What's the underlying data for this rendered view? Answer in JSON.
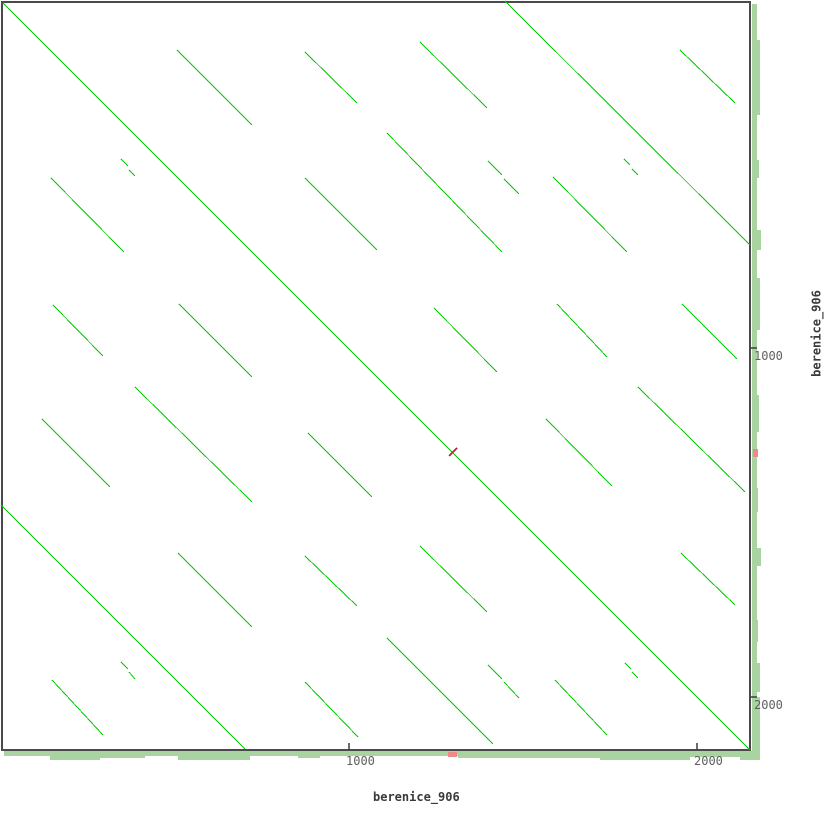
{
  "axis_labels": {
    "x": "berenice_906",
    "y": "berenice_906"
  },
  "axis": {
    "x_ticks": [
      {
        "label": "1000",
        "px": 349
      },
      {
        "label": "2000",
        "px": 697
      }
    ],
    "y_ticks": [
      {
        "label": "1000",
        "px": 348
      },
      {
        "label": "2000",
        "px": 697
      }
    ]
  },
  "colors": {
    "match_line": "#00cc00",
    "inverted_match": "#c22233",
    "density_band": "#a9d4a2",
    "band_red": "#ee8a8a",
    "plot_border": "#4a4a4a",
    "tick_mark": "#3c3c3c",
    "tick_text": "#5f5f5f",
    "label_text": "#3a3a3a",
    "background": "#ffffff"
  },
  "chart_data": {
    "type": "scatter",
    "subtype": "dotplot-self-alignment",
    "title": "",
    "xlabel": "berenice_906",
    "ylabel": "berenice_906",
    "x_range_bp": [
      0,
      2160
    ],
    "y_range_bp": [
      0,
      2160
    ],
    "tick_values_bp": [
      1000,
      2000
    ],
    "px_per_bp": 0.347,
    "plot_rect_px": {
      "x": 2,
      "y": 2,
      "w": 748,
      "h": 748
    },
    "main_diagonal_px": [
      3,
      3,
      750,
      750
    ],
    "match_segments_px": [
      [
        177,
        50,
        252,
        125
      ],
      [
        305,
        52,
        357,
        103
      ],
      [
        51,
        178,
        124,
        252
      ],
      [
        305,
        178,
        377,
        250
      ],
      [
        53,
        305,
        103,
        356
      ],
      [
        179,
        304,
        252,
        377
      ],
      [
        505,
        1,
        750,
        245
      ],
      [
        420,
        42,
        487,
        108
      ],
      [
        680,
        50,
        735,
        103
      ],
      [
        387,
        133,
        502,
        252
      ],
      [
        553,
        177,
        627,
        252
      ],
      [
        434,
        308,
        497,
        372
      ],
      [
        557,
        304,
        607,
        357
      ],
      [
        682,
        304,
        737,
        359
      ],
      [
        135,
        387,
        252,
        502
      ],
      [
        1,
        505,
        245,
        749
      ],
      [
        42,
        419,
        110,
        487
      ],
      [
        308,
        433,
        372,
        497
      ],
      [
        178,
        553,
        252,
        627
      ],
      [
        305,
        556,
        357,
        606
      ],
      [
        52,
        680,
        103,
        735
      ],
      [
        305,
        682,
        358,
        737
      ],
      [
        638,
        387,
        745,
        492
      ],
      [
        546,
        419,
        612,
        486
      ],
      [
        420,
        546,
        487,
        612
      ],
      [
        681,
        553,
        735,
        605
      ],
      [
        387,
        638,
        493,
        744
      ],
      [
        555,
        680,
        607,
        735
      ],
      [
        121,
        159,
        128,
        166
      ],
      [
        129,
        170,
        135,
        176
      ],
      [
        488,
        161,
        502,
        175
      ],
      [
        504,
        179,
        519,
        194
      ],
      [
        624,
        159,
        630,
        165
      ],
      [
        632,
        169,
        638,
        175
      ],
      [
        121,
        662,
        128,
        669
      ],
      [
        129,
        672,
        135,
        679
      ],
      [
        488,
        665,
        502,
        679
      ],
      [
        504,
        682,
        519,
        698
      ],
      [
        625,
        663,
        631,
        669
      ],
      [
        632,
        672,
        638,
        678
      ]
    ],
    "inverted_match_px": [
      449,
      456,
      457,
      448
    ],
    "density_bands": {
      "bottom": {
        "base": {
          "from": 4,
          "to": 757,
          "start": 751,
          "thickness": 5
        },
        "bumps": [
          [
            50,
            100,
            9
          ],
          [
            100,
            145,
            7
          ],
          [
            178,
            250,
            9
          ],
          [
            298,
            320,
            7
          ],
          [
            458,
            600,
            7
          ],
          [
            600,
            690,
            9
          ],
          [
            690,
            757,
            6
          ],
          [
            740,
            760,
            9
          ]
        ]
      },
      "right": {
        "base": {
          "from": 4,
          "to": 757,
          "start": 752,
          "thickness": 5
        },
        "bumps": [
          [
            40,
            115,
            8
          ],
          [
            160,
            178,
            7
          ],
          [
            230,
            250,
            9
          ],
          [
            278,
            330,
            8
          ],
          [
            395,
            432,
            7
          ],
          [
            488,
            512,
            6
          ],
          [
            548,
            566,
            9
          ],
          [
            620,
            642,
            6
          ],
          [
            663,
            692,
            8
          ],
          [
            697,
            752,
            8
          ]
        ]
      },
      "bottom_red_px": [
        448,
        457
      ],
      "right_red_px": [
        449,
        457
      ]
    },
    "legend": "green = direct repeat match, red = inverted match, side bands = match density"
  }
}
